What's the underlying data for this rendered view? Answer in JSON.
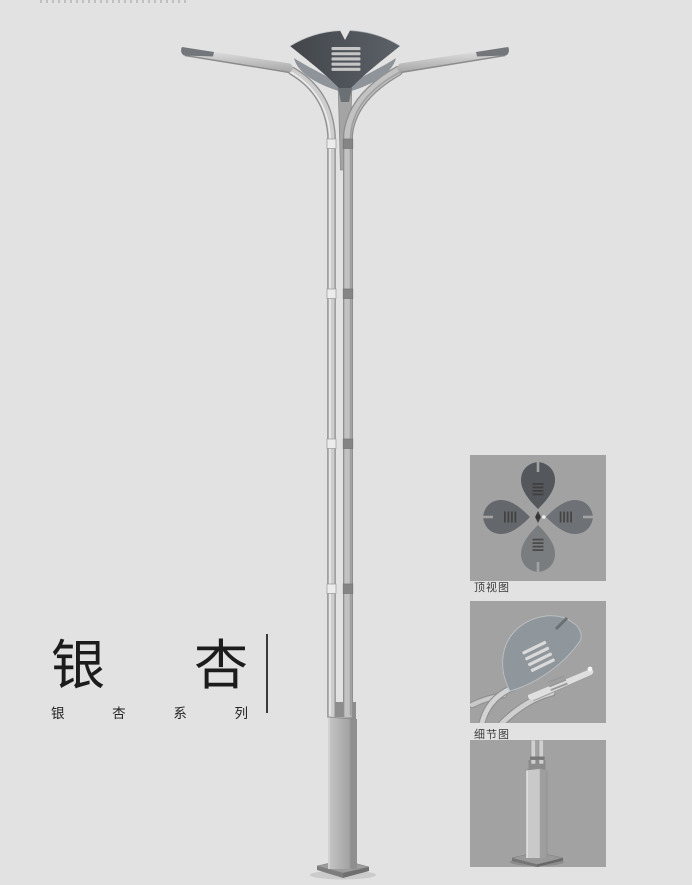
{
  "title": {
    "main_chars": [
      "银",
      "杏"
    ],
    "series_chars": [
      "银",
      "杏",
      "系",
      "列"
    ]
  },
  "figures": {
    "top_view": {
      "label": "顶视图"
    },
    "detail_view": {
      "label": "细节图"
    },
    "base_view": {
      "label": ""
    }
  },
  "colors": {
    "page_background": "#e2e2e2",
    "figure_background": "#a2a2a2",
    "crown_dark": "#4d5258",
    "pole_gray": "#c9c9c9",
    "title_text": "#1c1c1c"
  }
}
